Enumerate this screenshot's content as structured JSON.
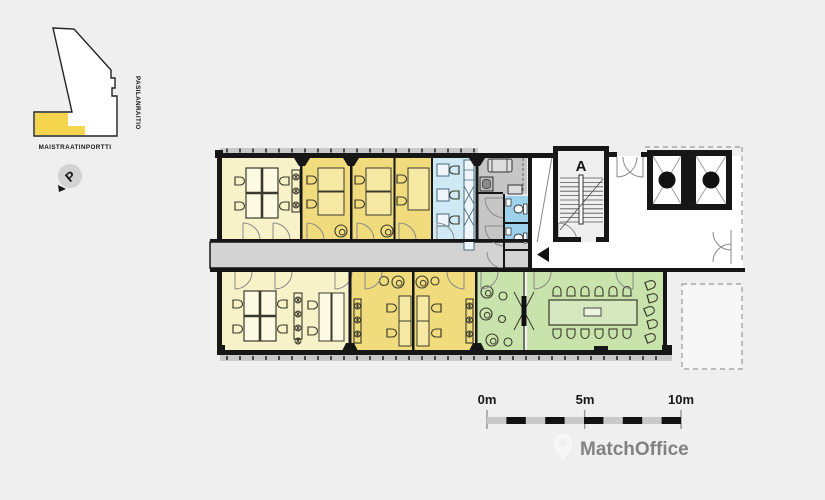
{
  "page": {
    "background_color": "#efeff0"
  },
  "site_map": {
    "street_label_bottom": "MAISTRAATINPORTTI",
    "street_label_right": "PASILANRAITIO",
    "north_letter": "P",
    "highlight_color": "#f5d54e"
  },
  "floor_plan": {
    "stairwell_label": "A",
    "elevator_arrows": "↑↓",
    "colors": {
      "office_light": "#f8f2c9",
      "office_dark": "#f1dc7d",
      "kitchen_blue": "#cfe9f5",
      "wc_blue": "#9ed2ec",
      "green": "#c9e3ac",
      "corridor_gray": "#d3d3d3",
      "service_gray": "#c6c6c6",
      "wall_black": "#161616"
    },
    "icons": {
      "north": "north-arrow-icon",
      "elevator": "elevator-updown-icon",
      "corridor_direction": "left-arrow-icon"
    }
  },
  "scale_bar": {
    "labels": [
      "0m",
      "5m",
      "10m"
    ]
  },
  "watermark": {
    "text": "MatchOffice"
  }
}
